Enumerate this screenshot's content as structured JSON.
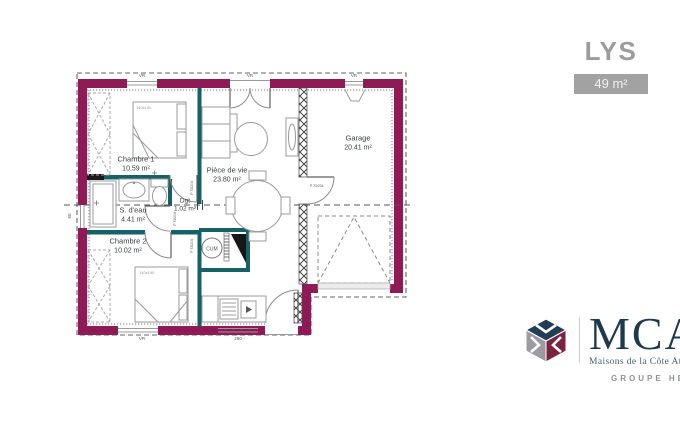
{
  "header": {
    "plan_name": "LYS",
    "surface_badge": "49 m²"
  },
  "plan": {
    "rooms": [
      {
        "name": "Chambre 1",
        "area": "10.59 m²"
      },
      {
        "name": "S. d'eau",
        "area": "4.41 m²"
      },
      {
        "name": "Chambre 2",
        "area": "10.02 m²"
      },
      {
        "name": "Pièce de vie",
        "area": "23.80 m²"
      },
      {
        "name": "Dgt",
        "area": "1.02 m²"
      },
      {
        "name": "Garage",
        "area": "20.41 m²"
      }
    ],
    "annotations": {
      "water_heater": "CUM",
      "bed_size": "140x190",
      "door_spec": "P 73/204",
      "roller_shutter": "VR",
      "left_window_width": "60",
      "kitchen_window_width": "260"
    },
    "colors": {
      "exterior_wall": "#8e1b55",
      "partition": "#166168"
    }
  },
  "branding": {
    "logo_text": "MCA",
    "logo_subtitle": "Maisons de la Côte Atlantique",
    "logo_group": "GROUPE HEXAOM",
    "colors": {
      "navy": "#1d3950",
      "maroon": "#7c2342",
      "gray": "#9b9ba1"
    }
  }
}
